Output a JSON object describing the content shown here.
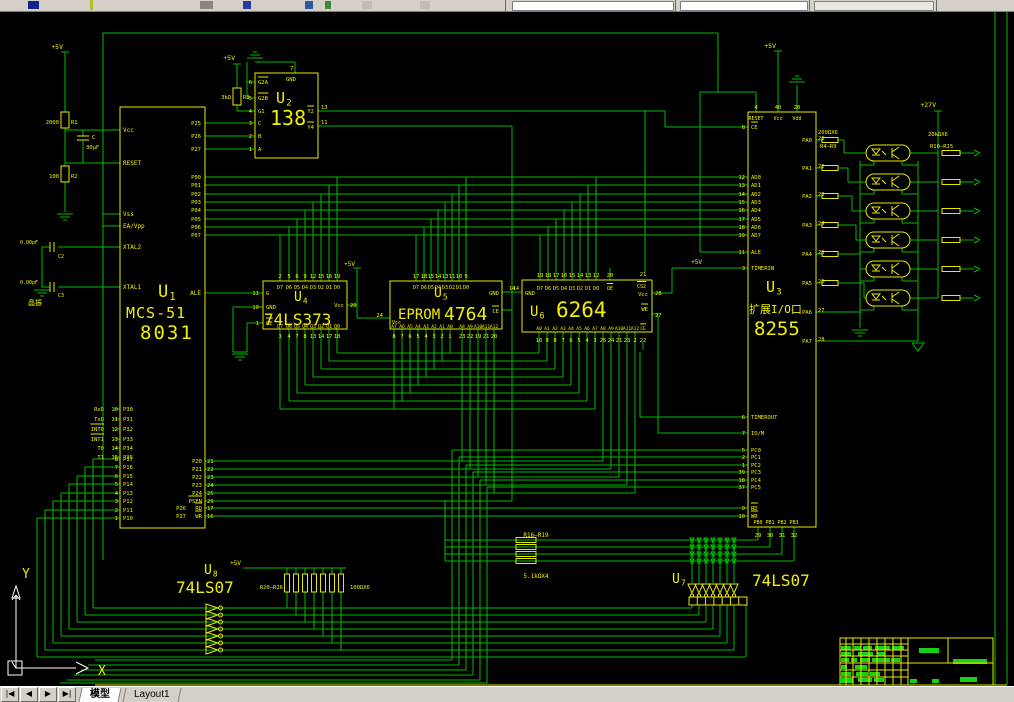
{
  "tabbar": {
    "nav": [
      "|◀",
      "◀",
      "▶",
      "▶|"
    ],
    "tabs": [
      {
        "label": "模型",
        "active": true
      },
      {
        "label": "Layout1",
        "active": false
      }
    ]
  },
  "ucs": {
    "x_label": "X",
    "y_label": "Y"
  },
  "colors": {
    "wire": "#00bc00",
    "component": "#e9e900",
    "text": "#f0f000",
    "green_text": "#25c840",
    "white": "#ffffff",
    "bg": "#000000"
  },
  "schematic": {
    "power": {
      "p5": "+5V",
      "p27": "+27V"
    },
    "reset_circuit": {
      "r1_value": "2000",
      "r1_ref": "R1",
      "cap_ref": "C",
      "cap_value": "30μF",
      "r2_value": "100",
      "r2_ref": "R2"
    },
    "xtal": {
      "c2_value": "0.00pF",
      "c2_ref": "C2",
      "c3_value": "0.00pF",
      "c3_ref": "C3",
      "note": "晶振"
    },
    "u1": {
      "ref": "U1",
      "title1": "MCS-51",
      "title2": "8031",
      "left_top": [
        "Vcc",
        "RESET",
        "Vss",
        "EA/Vpp",
        "XTAL2",
        "XTAL1"
      ],
      "serial_names": [
        "RxD",
        "TxD",
        "INT0",
        "INT1",
        "T0",
        "T1"
      ],
      "serial_numbers": [
        "10",
        "11",
        "12",
        "13",
        "14",
        "15"
      ],
      "serial_inner": [
        "P30",
        "P31",
        "P32",
        "P33",
        "P34",
        "P35"
      ],
      "p1_numbers": [
        "8",
        "7",
        "6",
        "5",
        "4",
        "3",
        "2",
        "1"
      ],
      "p1_inner": [
        "P17",
        "P16",
        "P15",
        "P14",
        "P13",
        "P12",
        "P11",
        "P10"
      ],
      "right_top": [
        "P25",
        "P26",
        "P27"
      ],
      "p0": [
        "P00",
        "P01",
        "P02",
        "P03",
        "P04",
        "P05",
        "P06",
        "P07"
      ],
      "ale": "ALE",
      "p2_inner": [
        "P20",
        "P21",
        "P22",
        "P23",
        "P24",
        "PSEN",
        "RD",
        "WR"
      ],
      "p2_prefix": [
        "",
        "",
        "",
        "",
        "",
        "",
        "P26",
        "P27"
      ],
      "p2_numbers": [
        "21",
        "22",
        "23",
        "24",
        "25",
        "29",
        "17",
        "16"
      ]
    },
    "u2": {
      "ref": "U2",
      "title": "138",
      "top_label": "GND",
      "top_number": "7",
      "left_numbers": [
        "6",
        "5",
        "4",
        "3",
        "2",
        "1"
      ],
      "left_labels": [
        "G2A",
        "G2B",
        "G1",
        "C",
        "B",
        "A"
      ],
      "right_numbers": [
        "13",
        "11"
      ],
      "right_labels": [
        "Y2",
        "Y4"
      ],
      "r3_value": "3kΩ",
      "r3_ref": "R3"
    },
    "u3": {
      "ref": "U3",
      "title1": "扩展I/O口",
      "title2": "8255",
      "top_numbers": [
        "4",
        "40",
        "20"
      ],
      "top_labels": [
        "RESET",
        "Vcc",
        "Vdd"
      ],
      "left_numbers": [
        "8",
        "12",
        "13",
        "14",
        "15",
        "16",
        "17",
        "18",
        "19",
        "11",
        "3",
        "6",
        "7",
        "5",
        "2",
        "1",
        "39",
        "38",
        "37",
        "9",
        "10"
      ],
      "left_labels": [
        "CE",
        "AD0",
        "AD1",
        "AD2",
        "AD3",
        "AD4",
        "AD5",
        "AD6",
        "AD7",
        "ALE",
        "TIMERIN",
        "TIMEROUT",
        "IO/M",
        "PC0",
        "PC1",
        "PC2",
        "PC3",
        "PC4",
        "PC5",
        "RD",
        "WR"
      ],
      "right_labels": [
        "PA0",
        "PA1",
        "PA2",
        "PA3",
        "PA4",
        "PA5",
        "PA6",
        "PA7"
      ],
      "right_numbers": [
        "21",
        "22",
        "23",
        "24",
        "25",
        "26",
        "27",
        "28"
      ],
      "bottom_labels": [
        "PB0",
        "PB1",
        "PB2",
        "PB3"
      ],
      "bottom_numbers": [
        "29",
        "30",
        "31",
        "32"
      ]
    },
    "u4": {
      "ref": "U4",
      "title": "74LS373",
      "top_numbers": [
        "2",
        "5",
        "6",
        "9",
        "12",
        "15",
        "16",
        "19"
      ],
      "top_labels": [
        "D7",
        "D6",
        "D5",
        "D4",
        "D3",
        "D2",
        "D1",
        "D0"
      ],
      "bottom_numbers": [
        "3",
        "4",
        "7",
        "8",
        "13",
        "14",
        "17",
        "18"
      ],
      "bottom_labels": [
        "Q7",
        "Q6",
        "Q5",
        "Q4",
        "Q3",
        "Q2",
        "Q1",
        "Q0"
      ],
      "left_numbers": [
        "11",
        "10",
        "1"
      ],
      "left_labels": [
        "G",
        "GND",
        "OE"
      ],
      "right_label": "Vcc",
      "right_number": "20"
    },
    "u5": {
      "ref": "U5",
      "title_green": "EPROM",
      "title_yellow": "4764",
      "top_numbers": [
        "17",
        "18",
        "15",
        "14",
        "13",
        "11",
        "10",
        "9"
      ],
      "top_labels": [
        "D7",
        "D6",
        "D5",
        "D4",
        "D3",
        "D2",
        "D1",
        "D0"
      ],
      "bottom_numbers": [
        "8",
        "7",
        "6",
        "5",
        "4",
        "3",
        "2",
        "1",
        "23",
        "22",
        "19",
        "21",
        "20"
      ],
      "bottom_labels": [
        "A7",
        "A6",
        "A5",
        "A4",
        "A3",
        "A2",
        "A1",
        "A0",
        "A8",
        "A9",
        "A10",
        "A11",
        "A12"
      ],
      "left_number": "24",
      "left_label": "Vcc",
      "right_labels": [
        "GND",
        "CE"
      ],
      "gnd_number": "14"
    },
    "u6": {
      "ref": "U6",
      "title": "6264",
      "top_numbers": [
        "19",
        "18",
        "17",
        "16",
        "15",
        "14",
        "13",
        "12",
        "20"
      ],
      "top_labels": [
        "D7",
        "D6",
        "D5",
        "D4",
        "D3",
        "D2",
        "D1",
        "D0",
        "OE"
      ],
      "bottom_numbers": [
        "10",
        "9",
        "8",
        "7",
        "6",
        "5",
        "4",
        "3",
        "25",
        "24",
        "21",
        "23",
        "2",
        "22"
      ],
      "bottom_labels": [
        "A0",
        "A1",
        "A2",
        "A3",
        "A4",
        "A5",
        "A6",
        "A7",
        "A8",
        "A9",
        "A10",
        "A11",
        "A12",
        "CE"
      ],
      "left_number": "14",
      "left_label": "GND",
      "right_numbers": [
        "21",
        "28",
        "",
        "27"
      ],
      "right_labels": [
        "CS2",
        "Vcc",
        "WE",
        ""
      ]
    },
    "u7": {
      "ref": "U7",
      "title": "74LS07"
    },
    "u8": {
      "ref": "U8",
      "title": "74LS07",
      "r_ref": "R20—R26",
      "r_value": "100ΩX6"
    },
    "opto": {
      "r_left_value": "200ΩX6",
      "r_left_ref": "R4—R9",
      "r_right_value": "20kΩX6",
      "r_right_ref": "R10—R15"
    },
    "rnet": {
      "ref": "R16—R19",
      "value": "5.1kΩX4"
    }
  }
}
